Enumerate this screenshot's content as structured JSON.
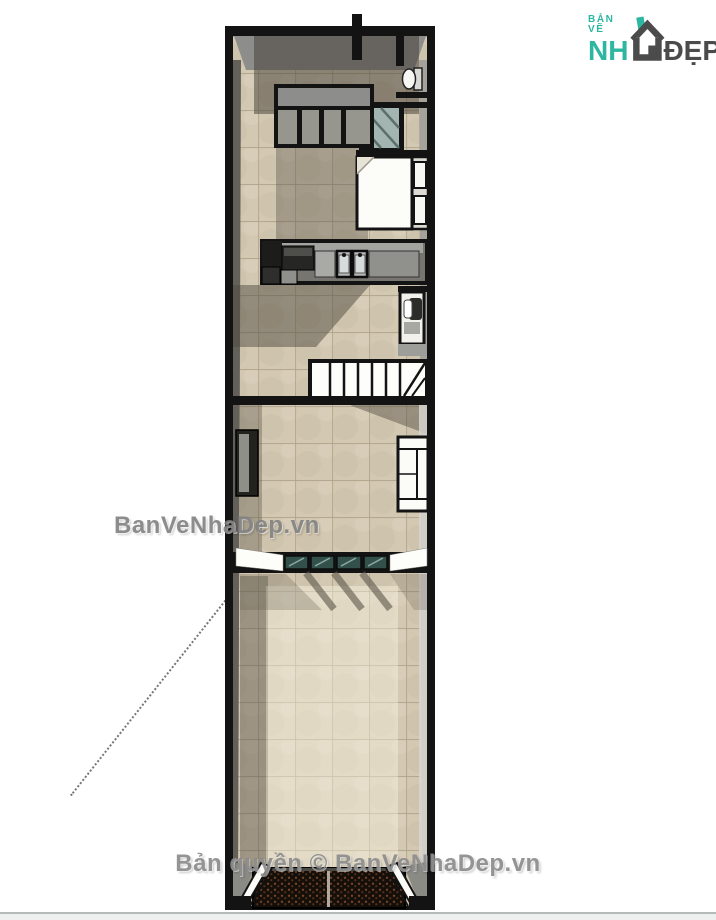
{
  "page": {
    "background": "#ffffff",
    "bottom_strip_color": "#eef0ef"
  },
  "logo": {
    "tagline": "BẢN VẼ",
    "name_prefix": "NH",
    "name_suffix": "ĐẸP",
    "teal": "#2eb7a0",
    "gray": "#4b4b4b"
  },
  "watermarks": {
    "center": "BanVeNhaDep.vn",
    "footer": "Bản quyền © BanVeNhaDep.vn"
  },
  "floor_plan": {
    "view": "top-down perspective render of a narrow tube house storey",
    "colors": {
      "wall": "#131313",
      "floor_tile": "#cfc3ad",
      "tile_grout": "#ab9f85",
      "wall_top_face": "#8d8d8b",
      "partition_glass": "#33514a",
      "shower_glass": "#a3b5b1",
      "counter": "#77756f",
      "doormat": "#150f09",
      "doormat_dot": "#77422a",
      "shadow": "#565048"
    },
    "elements": [
      "toilet",
      "shower-enclosure",
      "void-railing",
      "double-bed",
      "kitchen-counter",
      "cooktop",
      "double-sink",
      "under-stair-wc",
      "staircase",
      "wardrobe",
      "sofa",
      "glass-partition",
      "entry-doormat",
      "entry-doors",
      "dashed-guide-line"
    ]
  }
}
